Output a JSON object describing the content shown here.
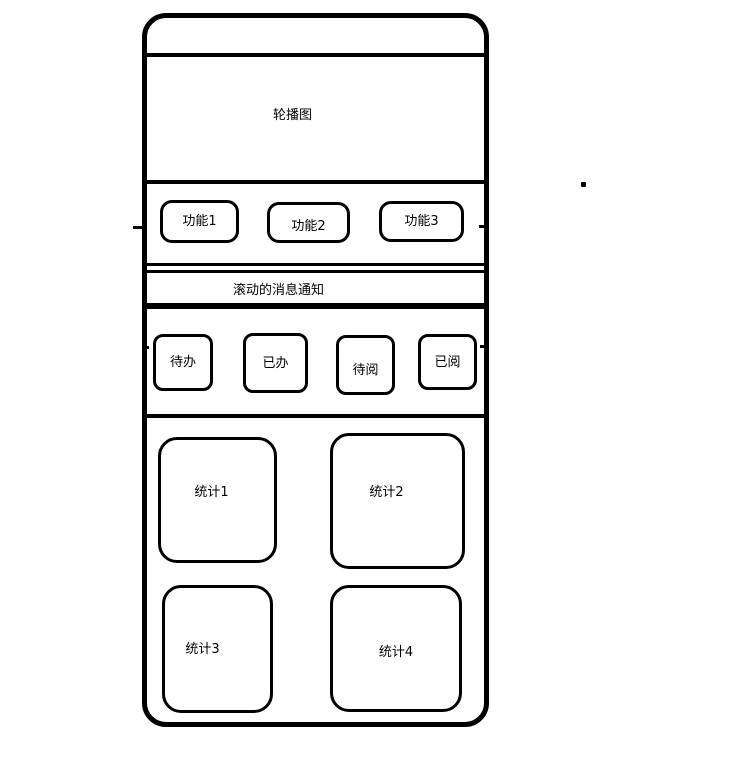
{
  "canvas": {
    "background": "#ffffff",
    "line_color": "#000000",
    "text_color": "#000000"
  },
  "wireframe": {
    "carousel": {
      "label": "轮播图"
    },
    "functions": {
      "items": [
        {
          "label": "功能1"
        },
        {
          "label": "功能2"
        },
        {
          "label": "功能3"
        }
      ]
    },
    "notice": {
      "label": "滚动的消息通知"
    },
    "badges": {
      "items": [
        {
          "label": "待办"
        },
        {
          "label": "已办"
        },
        {
          "label": "待阅"
        },
        {
          "label": "已阅"
        }
      ]
    },
    "stats": {
      "items": [
        {
          "label": "统计1"
        },
        {
          "label": "统计2"
        },
        {
          "label": "统计3"
        },
        {
          "label": "统计4"
        }
      ]
    }
  }
}
